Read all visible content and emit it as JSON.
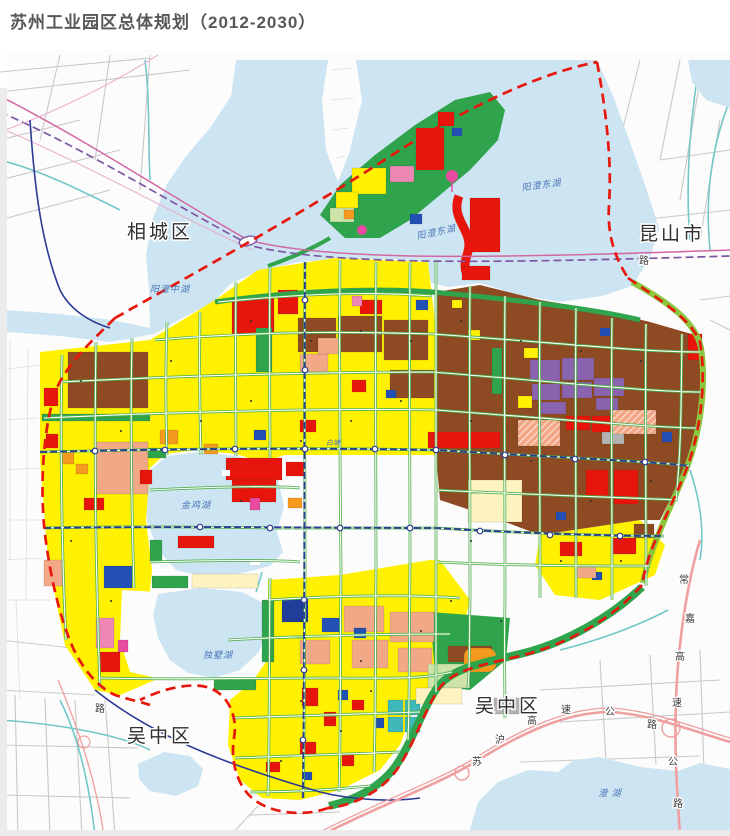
{
  "page": {
    "title": "苏州工业园区总体规划（2012-2030）"
  },
  "map": {
    "district_labels": [
      {
        "text": "相城区",
        "x": 160,
        "y": 238
      },
      {
        "text": "昆山市",
        "x": 672,
        "y": 240
      },
      {
        "text": "吴中区",
        "x": 160,
        "y": 742
      },
      {
        "text": "吴中区",
        "x": 508,
        "y": 712
      }
    ],
    "lake_labels": [
      {
        "text": "阳澄中湖",
        "x": 170,
        "y": 292
      },
      {
        "text": "阳澄东湖",
        "x": 437,
        "y": 235
      },
      {
        "text": "阳澄东湖",
        "x": 542,
        "y": 188
      },
      {
        "text": "金鸡湖",
        "x": 196,
        "y": 508
      },
      {
        "text": "独墅湖",
        "x": 218,
        "y": 658
      },
      {
        "text": "澄  湖",
        "x": 610,
        "y": 796
      },
      {
        "text": "白塘",
        "x": 333,
        "y": 445
      }
    ],
    "road_labels": [
      {
        "text": "苏",
        "x": 477,
        "y": 765
      },
      {
        "text": "沪",
        "x": 500,
        "y": 743
      },
      {
        "text": "高",
        "x": 532,
        "y": 724
      },
      {
        "text": "速",
        "x": 566,
        "y": 713
      },
      {
        "text": "公",
        "x": 610,
        "y": 715
      },
      {
        "text": "路",
        "x": 652,
        "y": 728
      },
      {
        "text": "常",
        "x": 684,
        "y": 583
      },
      {
        "text": "嘉",
        "x": 690,
        "y": 622
      },
      {
        "text": "高",
        "x": 680,
        "y": 660
      },
      {
        "text": "速",
        "x": 677,
        "y": 706
      },
      {
        "text": "公",
        "x": 673,
        "y": 765
      },
      {
        "text": "路",
        "x": 678,
        "y": 807
      },
      {
        "text": "路",
        "x": 644,
        "y": 264
      },
      {
        "text": "路",
        "x": 100,
        "y": 712
      }
    ],
    "legend_palette": {
      "water": "#cde5f2",
      "waterText": "#4a74b8",
      "outsideBg": "#fcfcfc",
      "outsideRoad": "#c9c9c9",
      "canal": "#72c7c9",
      "yellow": "#fff100",
      "red": "#e8150c",
      "brown": "#8e4a22",
      "salmon": "#f2a886",
      "purple": "#8a63ae",
      "orange": "#f59a1d",
      "blue": "#2350b4",
      "darkblue": "#1f3d99",
      "teal": "#3fb8ba",
      "pink": "#ee87b4",
      "magenta": "#e94ba0",
      "gray": "#b3b3b3",
      "park": "#2fa44c",
      "lime": "#8cc63e",
      "pale": "#cde3a8",
      "cream": "#fdf3c0",
      "metro": "#2b3a92",
      "railPurple": "#7e57a3",
      "railMagenta": "#d266a2",
      "highway": "#ef9f9f",
      "boundary": "#e8170e",
      "title": "#595757",
      "label": "#2f2f2f"
    }
  }
}
